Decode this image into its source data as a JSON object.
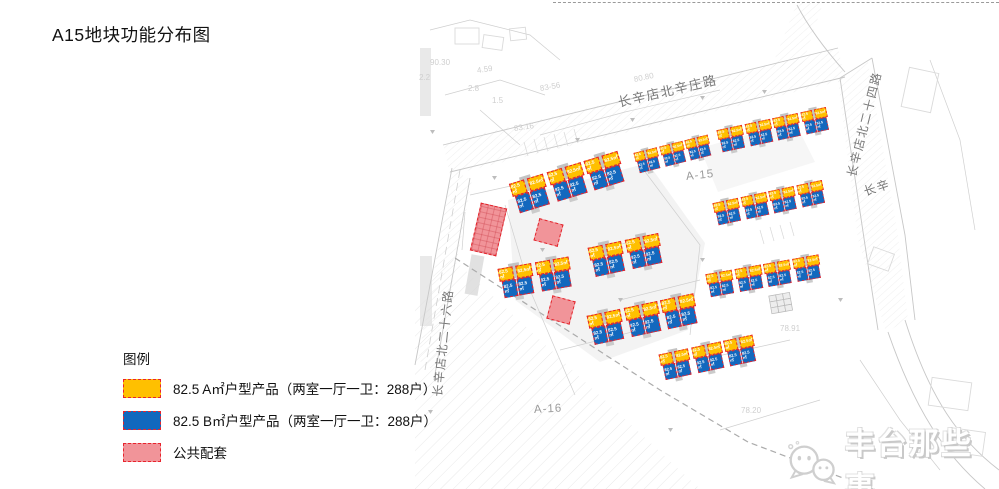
{
  "title": "A15地块功能分布图",
  "legend": {
    "heading": "图例",
    "items": [
      {
        "key": "type_a",
        "label": "82.5 A㎡户型产品（两室一厅一卫：288户）",
        "color": "#FFC000"
      },
      {
        "key": "type_b",
        "label": "82.5 B㎡户型产品（两室一厅一卫：288户）",
        "color": "#1268BE"
      },
      {
        "key": "public",
        "label": "公共配套",
        "color": "#F19499"
      }
    ],
    "swatch_border_color": "#E8242D"
  },
  "map": {
    "unit_label": "82.5㎡",
    "roads": [
      {
        "id": "north",
        "name": "长辛店北辛庄路",
        "x": 618,
        "y": 92,
        "rot": -13,
        "size": 13
      },
      {
        "id": "east",
        "name": "长辛店北二十四路",
        "x": 851,
        "y": 168,
        "rot": -76,
        "size": 12
      },
      {
        "id": "west",
        "name": "长辛店北二十六路",
        "x": 437,
        "y": 388,
        "rot": -84,
        "size": 12
      },
      {
        "id": "east-partial",
        "name": "长辛",
        "x": 864,
        "y": 183,
        "rot": -18,
        "size": 12
      }
    ],
    "parcels": [
      {
        "id": "a15",
        "name": "A-15",
        "x": 686,
        "y": 171,
        "rot": -6
      },
      {
        "id": "a16",
        "name": "A-16",
        "x": 534,
        "y": 404,
        "rot": -3
      }
    ],
    "elevations": [
      {
        "t": "90.30",
        "x": 430,
        "y": 58,
        "rot": 0
      },
      {
        "t": "2.2",
        "x": 419,
        "y": 73,
        "rot": 0
      },
      {
        "t": "4.59",
        "x": 477,
        "y": 66,
        "rot": -8
      },
      {
        "t": "2.8",
        "x": 468,
        "y": 84,
        "rot": 0
      },
      {
        "t": "83-56",
        "x": 540,
        "y": 84,
        "rot": -10
      },
      {
        "t": "1.5",
        "x": 492,
        "y": 96,
        "rot": 0
      },
      {
        "t": "83.16",
        "x": 514,
        "y": 124,
        "rot": -8
      },
      {
        "t": "80.80",
        "x": 634,
        "y": 75,
        "rot": -12
      },
      {
        "t": "78.91",
        "x": 780,
        "y": 324,
        "rot": 0
      },
      {
        "t": "78.20",
        "x": 741,
        "y": 406,
        "rot": 0
      }
    ],
    "clusters": [
      {
        "id": "top-left",
        "x": 508,
        "y": 181,
        "rot": -17,
        "scale": 1.04,
        "count": 3
      },
      {
        "id": "top-mid",
        "x": 633,
        "y": 151,
        "rot": -14,
        "scale": 0.7,
        "count": 3
      },
      {
        "id": "top-right",
        "x": 716,
        "y": 128,
        "rot": -12,
        "scale": 0.76,
        "count": 4
      },
      {
        "id": "right-mid",
        "x": 712,
        "y": 201,
        "rot": -12,
        "scale": 0.76,
        "count": 4
      },
      {
        "id": "mid-left",
        "x": 497,
        "y": 266,
        "rot": -10,
        "scale": 1.0,
        "count": 2
      },
      {
        "id": "mid",
        "x": 587,
        "y": 245,
        "rot": -12,
        "scale": 1.0,
        "count": 2
      },
      {
        "id": "right-low",
        "x": 705,
        "y": 272,
        "rot": -10,
        "scale": 0.78,
        "count": 4
      },
      {
        "id": "mid-low",
        "x": 586,
        "y": 313,
        "rot": -12,
        "scale": 1.0,
        "count": 3
      },
      {
        "id": "bottom",
        "x": 658,
        "y": 352,
        "rot": -12,
        "scale": 0.88,
        "count": 3
      }
    ],
    "public_blocks": [
      {
        "id": "tall",
        "x": 475,
        "y": 205,
        "w": 27,
        "h": 49,
        "rot": 13,
        "grid": true
      },
      {
        "id": "square-1",
        "x": 536,
        "y": 221,
        "w": 25,
        "h": 23,
        "rot": 15,
        "grid": false
      },
      {
        "id": "square-2",
        "x": 549,
        "y": 298,
        "w": 24,
        "h": 24,
        "rot": 15,
        "grid": false
      }
    ],
    "watermark": {
      "text": "丰台那些事"
    }
  },
  "colors": {
    "type_a": "#FFC000",
    "type_b": "#1268BE",
    "public": "#F19499",
    "dashed_border": "#E8232B",
    "core_gray": "#C3C3C3",
    "faint_line": "#CDCDCD"
  }
}
